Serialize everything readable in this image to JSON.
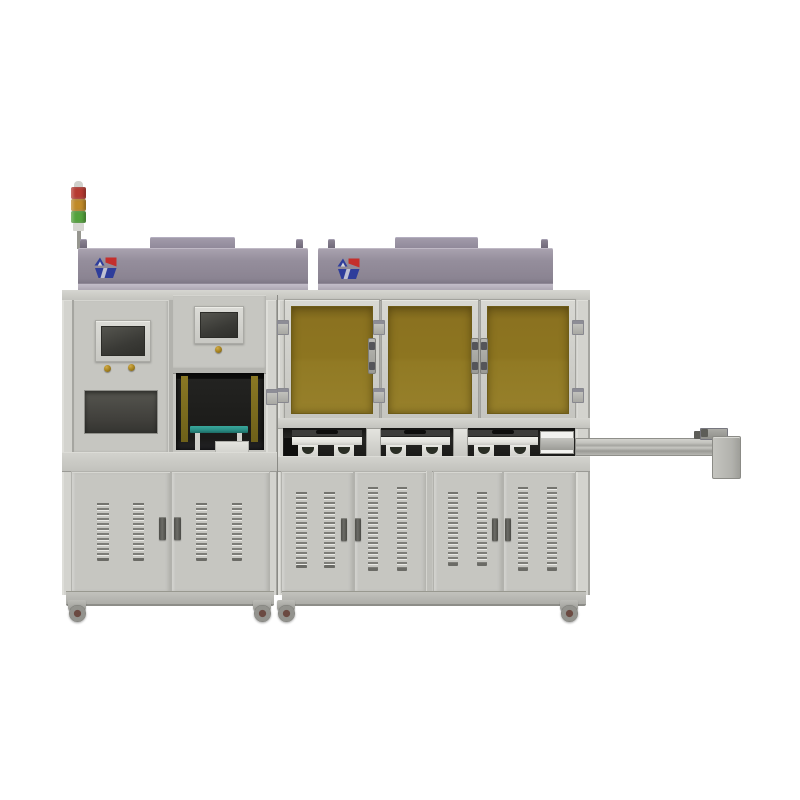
{
  "image": {
    "type": "product-render",
    "subject": "Two-bay industrial automation machine with signal tower, HMI screens, three amber safety windows, vented lower cabinets, casters and an output conveyor rail extending right",
    "background": "#ffffff"
  },
  "colors": {
    "bg": "#ffffff",
    "body": "#c6c6c1",
    "body_light": "#d3d3ce",
    "body_dark": "#a9a9a4",
    "frame_line": "#97978f",
    "housing": "#918a9b",
    "housing_light": "#a9a2b1",
    "housing_lip": "#b7b1bd",
    "amber_glass": "#8a7120",
    "amber_glass_light": "#97802b",
    "dark_interior": "#1e1e1c",
    "band_dark": "#262624",
    "module_white": "#e3e3de",
    "teal": "#2a8d84",
    "tower_red": "#b63a31",
    "tower_amber": "#c08a28",
    "tower_green": "#53a23c",
    "logo_blue": "#2e3d9b",
    "logo_red": "#c42f2c",
    "gold_button": "#a3801f",
    "handle_dark": "#595954",
    "vent": "#8e8e89",
    "caster_hub": "#6b4a42"
  },
  "tower_light": {
    "segments": [
      "red",
      "amber",
      "green"
    ]
  },
  "branding": {
    "logo": "blue-red monogram badge",
    "placements": [
      "left-housing",
      "right-housing"
    ]
  },
  "left_bay": {
    "hmi_screens": 2,
    "push_buttons": 3,
    "dark_window_panels": 1,
    "process_opening": {
      "fixture": "teal worktable with white box",
      "edge_strips": "amber"
    },
    "lower_doors": 2,
    "vent_columns_per_door": 2
  },
  "right_bay": {
    "amber_windows": 3,
    "window_hinges": 6,
    "lower_doors": 4,
    "vent_columns_per_door": 2,
    "conveyor_modules": 3
  },
  "output_conveyor": {
    "rail_segments": 1,
    "end_plate": 1,
    "top_sensor": 1
  },
  "casters": 4
}
